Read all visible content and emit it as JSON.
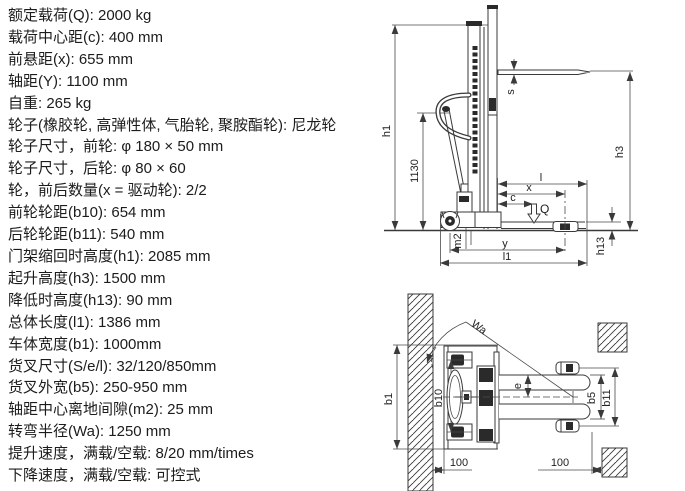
{
  "specs": {
    "lines": [
      "额定载荷(Q): 2000 kg",
      "载荷中心距(c): 400 mm",
      "前悬距(x): 655 mm",
      "轴距(Y): 1100 mm",
      "自重: 265 kg",
      "轮子(橡胶轮, 高弹性体, 气胎轮, 聚胺酯轮): 尼龙轮",
      "轮子尺寸，前轮: φ 180 × 50 mm",
      "轮子尺寸，后轮: φ 80 × 60",
      "轮，前后数量(x = 驱动轮): 2/2",
      "前轮轮距(b10): 654 mm",
      "后轮轮距(b11): 540 mm",
      "门架缩回时高度(h1): 2085 mm",
      "起升高度(h3): 1500 mm",
      "降低时高度(h13): 90 mm",
      "总体长度(l1): 1386 mm",
      "车体宽度(b1): 1000mm",
      "货叉尺寸(S/e/l): 32/120/850mm",
      "货叉外宽(b5): 250-950 mm",
      "轴距中心离地间隙(m2): 25 mm",
      "转弯半径(Wa): 1250 mm",
      "提升速度，满载/空载: 8/20 mm/times",
      "下降速度，满载/空载: 可控式"
    ]
  },
  "side_view": {
    "labels": {
      "h1": "h1",
      "mast_height": "1130",
      "s": "s",
      "h3": "h3",
      "l": "l",
      "x": "x",
      "c": "c",
      "q": "Q",
      "m2": "m2",
      "y": "y",
      "l1": "l1",
      "h13": "h13"
    }
  },
  "top_view": {
    "labels": {
      "wa": "Wa",
      "b1": "b1",
      "b10": "b10",
      "e": "e",
      "b5": "b5",
      "b11": "b11",
      "left_clearance": "100",
      "right_clearance": "100"
    }
  },
  "colors": {
    "line": "#3a3a3a",
    "text": "#1c1c1c",
    "background": "#ffffff"
  }
}
